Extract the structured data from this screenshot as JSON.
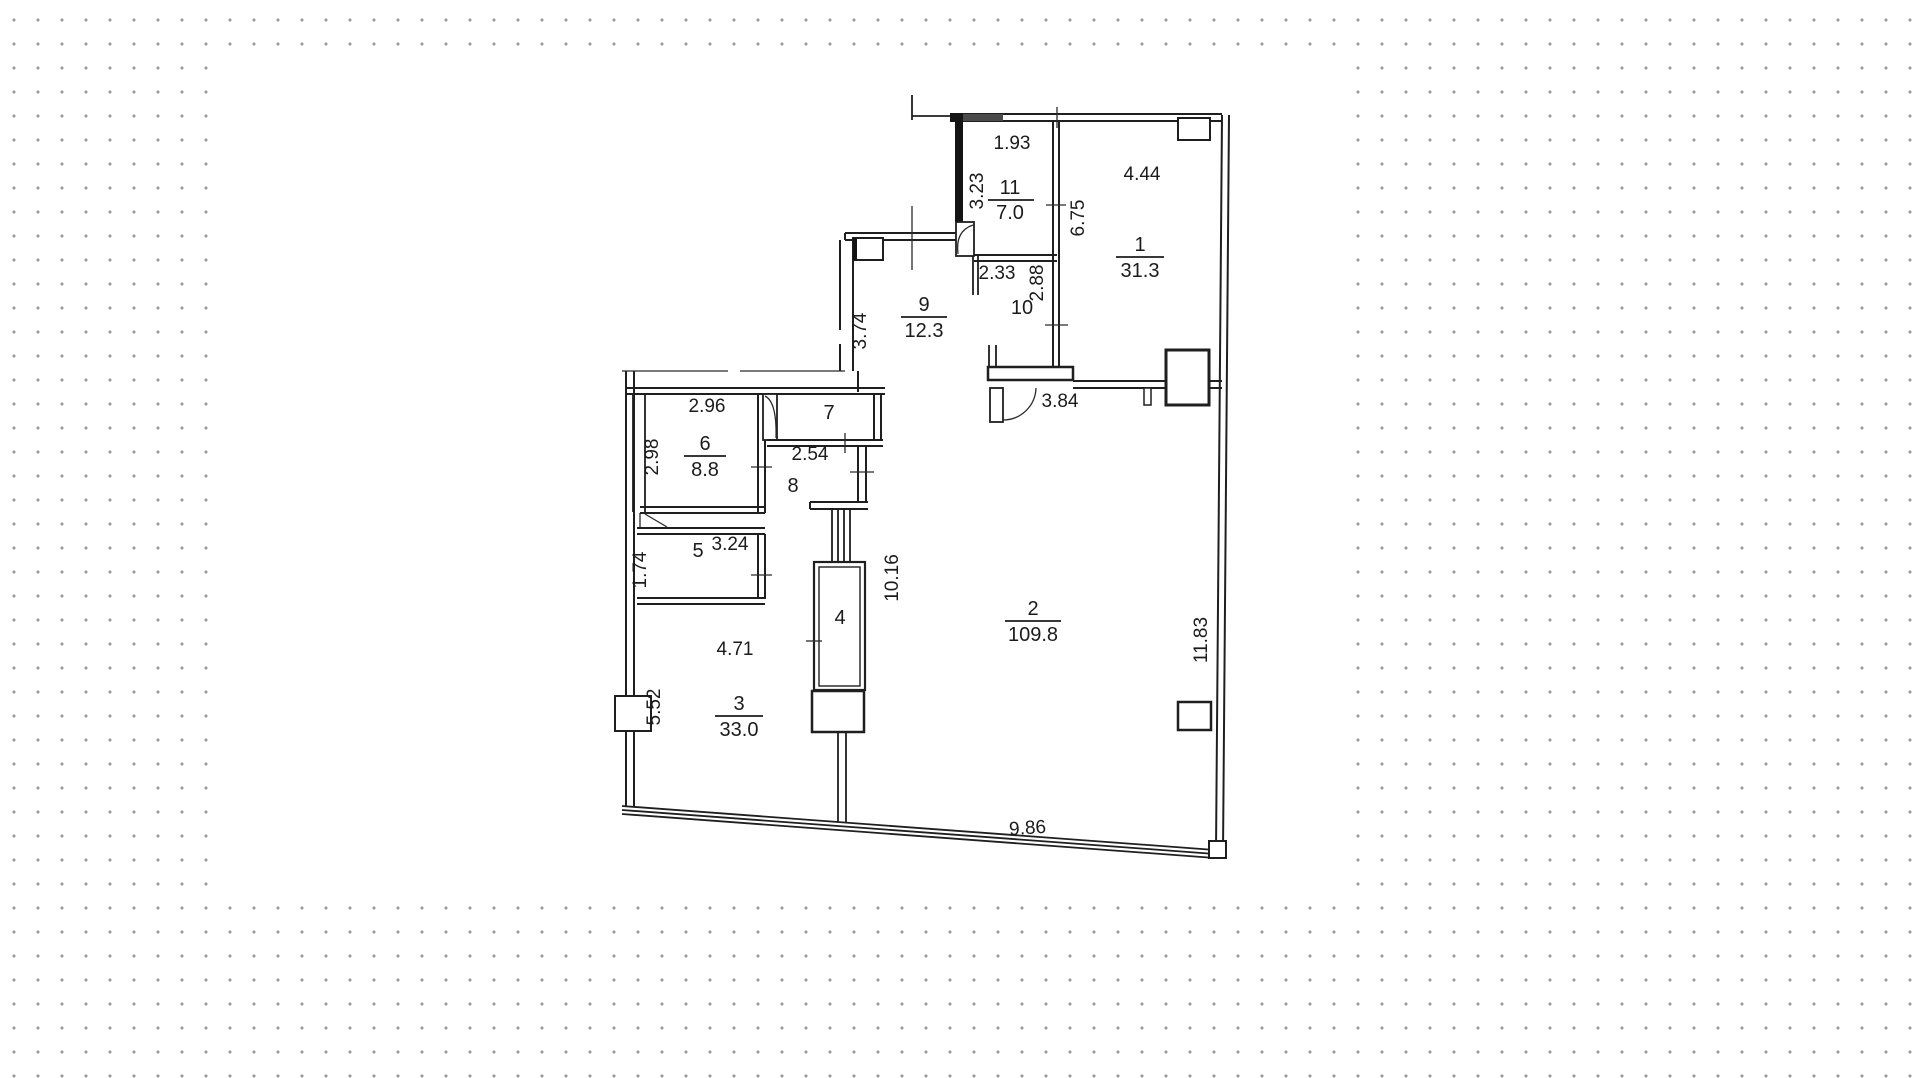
{
  "plan": {
    "rooms": {
      "r1": {
        "number": "1",
        "area": "31.3"
      },
      "r2": {
        "number": "2",
        "area": "109.8"
      },
      "r3": {
        "number": "3",
        "area": "33.0"
      },
      "r4": {
        "number": "4"
      },
      "r5": {
        "number": "5"
      },
      "r6": {
        "number": "6",
        "area": "8.8"
      },
      "r7": {
        "number": "7"
      },
      "r8": {
        "number": "8"
      },
      "r9": {
        "number": "9",
        "area": "12.3"
      },
      "r10": {
        "number": "10"
      },
      "r11": {
        "number": "11",
        "area": "7.0"
      }
    },
    "dims": {
      "d193": "1.93",
      "d323": "3.23",
      "d444": "4.44",
      "d675": "6.75",
      "d233": "2.33",
      "d288": "2.88",
      "d374": "3.74",
      "d384": "3.84",
      "d296": "2.96",
      "d298": "2.98",
      "d254": "2.54",
      "d324": "3.24",
      "d174": "1.74",
      "d1016": "10.16",
      "d471": "4.71",
      "d552": "5.52",
      "d1183": "11.83",
      "d986": "9.86"
    },
    "colors": {
      "line": "#1f1f1f",
      "dots": "#9e9e9e",
      "paper": "#ffffff"
    }
  }
}
